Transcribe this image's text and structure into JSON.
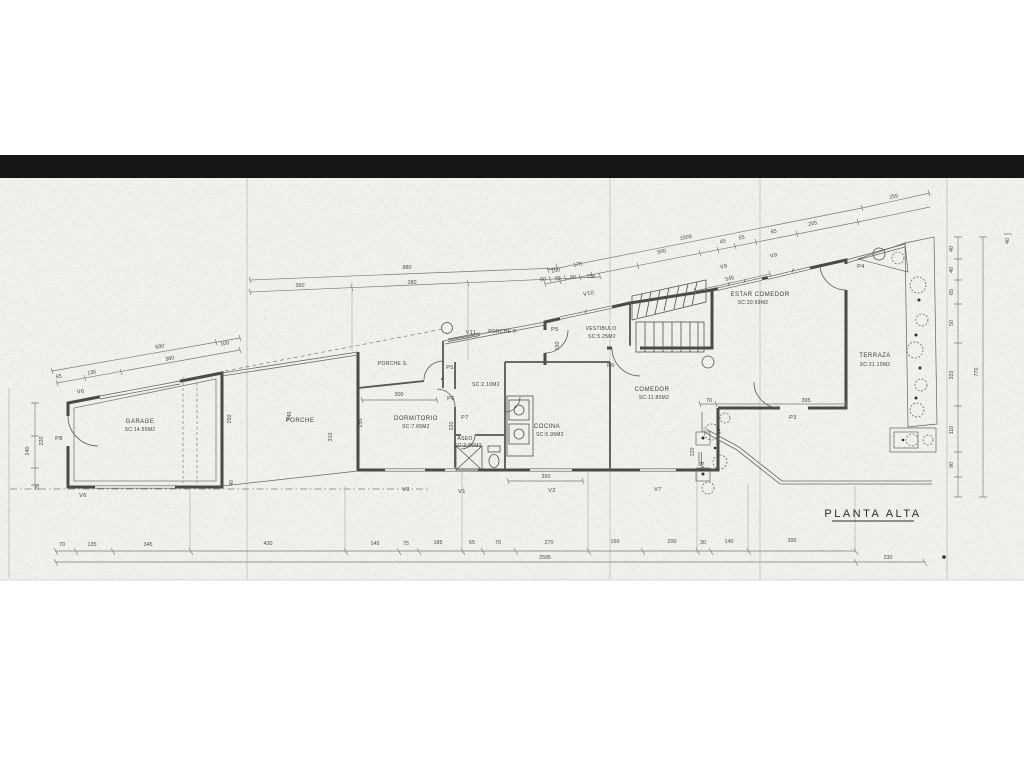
{
  "title": "PLANTA ALTA",
  "rooms": {
    "garage_name": "GARAGE",
    "garage_area": "SC:14.55M2",
    "porche_name": "PORCHE",
    "dormitorio_name": "DORMITORIO",
    "dormitorio_area": "SC:7.65M2",
    "aseo_name": "ASEO",
    "aseo_area": "SC:2.85M2",
    "porche_s_name": "PORCHE S.",
    "porche_p_name": "PORCHE P.",
    "distribuidor_area": "SC:2.10M2",
    "cocina_name": "COCINA",
    "cocina_area": "SC:5.95M2",
    "vestibulo_name": "VESTIBULO",
    "vestibulo_area": "SC:5.25M2",
    "comedor_name": "COMEDOR",
    "comedor_area": "SC:11.80M2",
    "estar_name": "ESTAR COMEDOR",
    "estar_area": "SC:20.59M2",
    "terraza_name": "TERRAZA",
    "terraza_area": "SC:21.10M2"
  },
  "doors": {
    "p3": "P3",
    "p4": "P4",
    "p5_porche": "P5",
    "p5_vestibulo": "P5",
    "p6_dormitorio": "P6",
    "p6_comedor": "P6",
    "p7": "P7",
    "p8": "P8"
  },
  "windows": {
    "v1": "V1",
    "v2": "V2",
    "v3": "V3",
    "v6_top": "V6",
    "v6_bottom": "V6",
    "v7": "V7",
    "v8": "V8",
    "v9_left": "V9",
    "v9_right": "V9",
    "v10": "V10",
    "v11": "V11"
  },
  "dims": {
    "bottom": {
      "b1": "70",
      "b2": "135",
      "b3": "345",
      "b4": "430",
      "b5": "145",
      "b6": "75",
      "b7": "185",
      "b8": "65",
      "b9": "70",
      "b10": "270",
      "b11": "160",
      "b12": "200",
      "b13": "30",
      "b14": "140",
      "b15": "395",
      "total": "2595",
      "ext": "230"
    },
    "top_mid": {
      "total": "880",
      "s1": "360",
      "s2": "280",
      "s3": "60",
      "s4": "65",
      "s5": "90",
      "s6": "155"
    },
    "top_right": {
      "total": "1009",
      "s1": "500",
      "s2": "45",
      "s3": "55",
      "s4": "65",
      "s5": "205",
      "s6": "255",
      "s7": "545",
      "s8": "100",
      "s9": "170"
    },
    "right": {
      "r1": "40",
      "r2": "40",
      "r3": "65",
      "r4": "50",
      "r5": "325",
      "r6": "110",
      "r7": "90",
      "total": "770",
      "corner": "40"
    },
    "left": {
      "l1": "240",
      "l2": "220",
      "l3": "25"
    },
    "garage": {
      "total": "630",
      "g1": "380",
      "g2": "100",
      "g3": "65",
      "g4": "135",
      "g5": "250",
      "g6": "40"
    },
    "porche": {
      "p1": "340",
      "p2": "310",
      "p3": "255"
    },
    "misc": {
      "m1": "300",
      "m2": "220",
      "m3": "350",
      "m4": "70",
      "m5": "395",
      "m6": "120",
      "m7": "150"
    }
  }
}
